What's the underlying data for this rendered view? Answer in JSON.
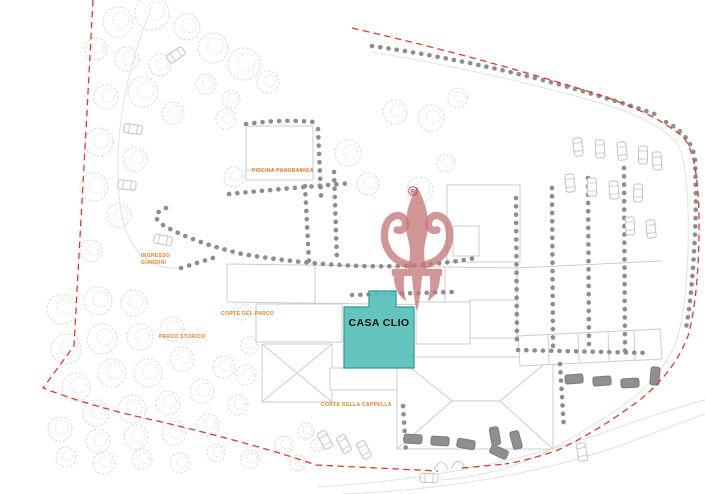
{
  "plan": {
    "unit_highlight": {
      "label": "CASA CLIO"
    },
    "area_labels": {
      "piscina": "PISCINA PANORAMICA",
      "ingresso_line1": "INGRESSO",
      "ingresso_line2": "GIARDINI",
      "corte_parco": "CORTE DEL PARCO",
      "parco_storico": "PARCO STORICO",
      "corte_cappella": "CORTE DELLA CAPPELLA"
    },
    "watermark": {
      "badge_letter": "B"
    },
    "colors": {
      "highlight_fill": "#5bc2ba",
      "highlight_border": "#2d9b91",
      "label_orange": "#f07d1e",
      "boundary_red": "#e2392c",
      "hedge_dot_gray": "#8d8d8d"
    }
  }
}
